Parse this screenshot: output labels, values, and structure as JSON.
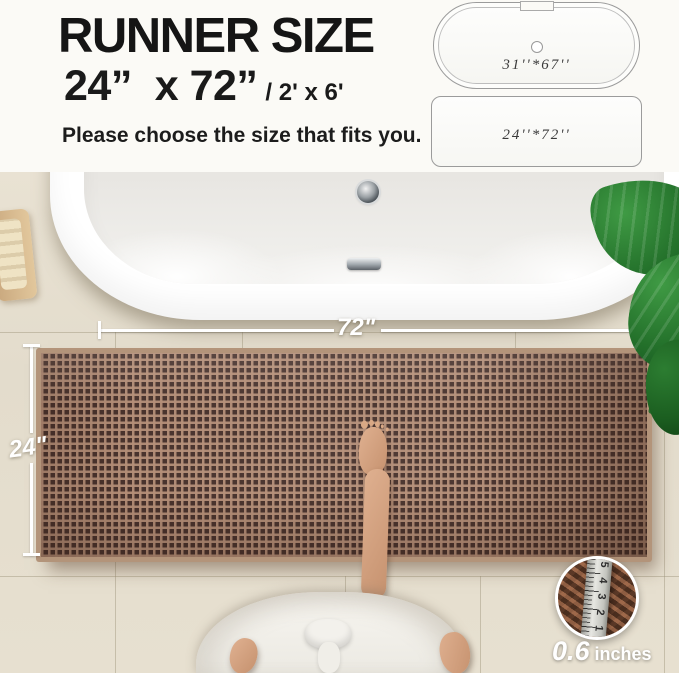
{
  "header": {
    "title": "RUNNER SIZE",
    "size_primary": "24”  x 72”",
    "size_secondary": "/ 2' x 6'",
    "subtitle": "Please choose the size that fits you."
  },
  "size_diagram": {
    "bathtub_label": "31''*67''",
    "runner_label": "24''*72''"
  },
  "scene": {
    "width_dimension_label": "72\"",
    "height_dimension_label": "24\""
  },
  "pile_inset": {
    "value": "0.6",
    "unit": "inches",
    "ruler_numbers": [
      "1",
      "2",
      "3",
      "4",
      "5"
    ]
  },
  "colors": {
    "rug_brown": "#46302a",
    "rug_weave_light": "#b38d76",
    "rug_fringe": "#b3947a",
    "floor_beige": "#e4ddcd",
    "plant_green": "#23702a",
    "text_dark": "#151515",
    "diagram_line_gray": "#9b9b9b",
    "dimension_line_white": "#ffffff"
  }
}
